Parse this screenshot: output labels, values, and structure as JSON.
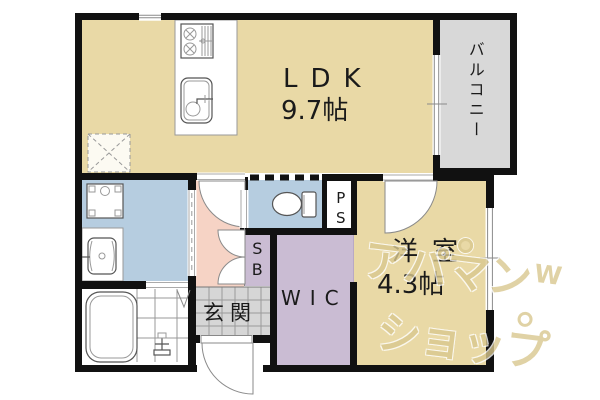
{
  "floorplan": {
    "rooms": {
      "ldk": {
        "label": "LDK",
        "size": "9.7帖"
      },
      "balcony": {
        "label": "バルコニー"
      },
      "western_room": {
        "label": "洋室",
        "size": "4.3帖"
      },
      "wic": {
        "label": "WIC"
      },
      "genkan": {
        "label": "玄関"
      },
      "shoe_box": {
        "label": "SB"
      },
      "pipe_space": {
        "label": "PS"
      }
    },
    "colors": {
      "ldk_fill": "#e9d9a6",
      "western_room_fill": "#e9d9a6",
      "hallway_fill": "#f6d3c5",
      "wet_room_fill": "#b6cde0",
      "closet_fill": "#cabcd3",
      "balcony_fill": "#d8d8d8",
      "genkan_tile_fill": "#d6d6d6",
      "wall": "#111111",
      "line": "#8a8a8a",
      "text": "#1a1a1a",
      "watermark": "#d9c88f"
    },
    "watermark": {
      "line1": "アパマン",
      "line2": "ショップ",
      "accent": "W"
    }
  }
}
